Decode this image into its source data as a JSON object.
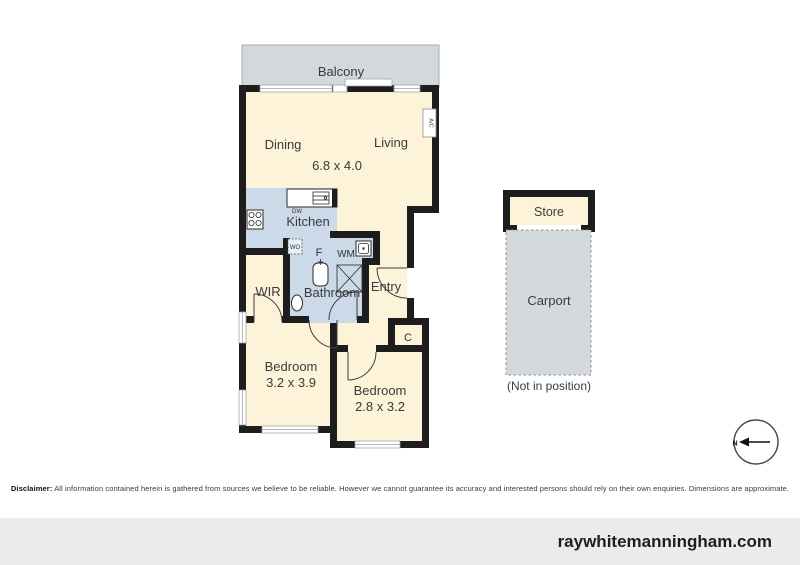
{
  "plan": {
    "balcony": "Balcony",
    "dining": "Dining",
    "living": "Living",
    "living_dining_dims": "6.8 x 4.0",
    "kitchen": "Kitchen",
    "wir": "WIR",
    "bathroom": "Bathroom",
    "entry": "Entry",
    "bedroom1": "Bedroom",
    "bedroom1_dims": "3.2 x 3.9",
    "bedroom2": "Bedroom",
    "bedroom2_dims": "2.8 x 3.2",
    "store": "Store",
    "carport": "Carport",
    "carport_note": "(Not in position)",
    "fixtures": {
      "dw": "DW",
      "wo": "WO",
      "fridge": "F",
      "wm": "WM",
      "closet": "C",
      "ac": "A/C"
    },
    "compass_n": "N"
  },
  "disclaimer": {
    "label": "Disclaimer:",
    "text": " All information contained herein is gathered from sources we believe to be reliable. However we cannot guarantee its accuracy and interested persons should rely on their own enquiries. Dimensions are approximate."
  },
  "footer": {
    "website": "raywhitemanningham.com"
  },
  "colors": {
    "room_fill": "#FCF3D9",
    "wet_area_fill": "#CBD9E9",
    "outdoor_fill": "#D3D8DC",
    "carport_fill": "#D4D9DD",
    "wall": "#1D1D1D",
    "footer_bg": "#E9EBEC"
  }
}
